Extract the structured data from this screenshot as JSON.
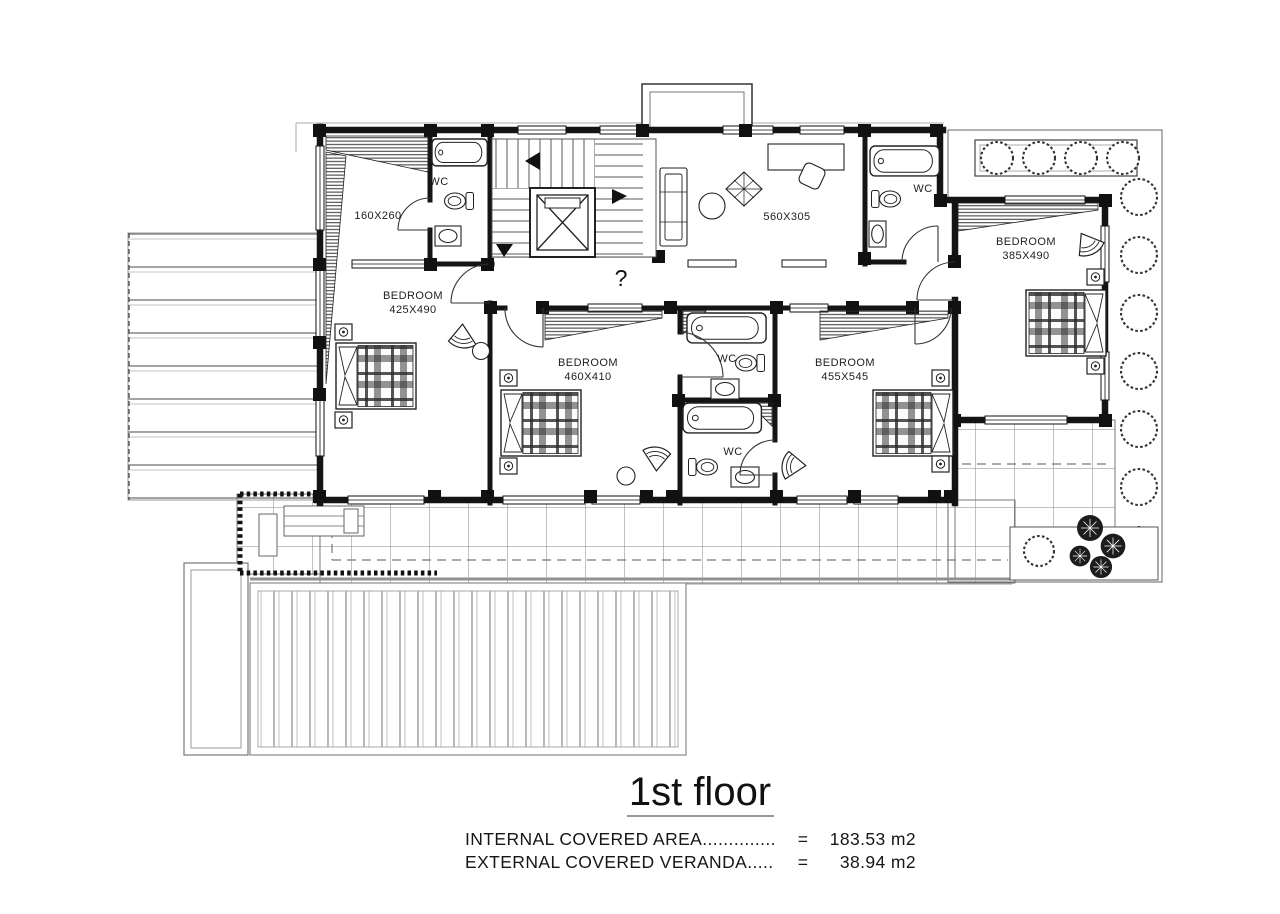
{
  "plan": {
    "rooms": {
      "dressing": {
        "dim": "160X260"
      },
      "wc_top_left": {
        "label": "WC"
      },
      "wc_top_right": {
        "label": "WC"
      },
      "wc_middle_upper": {
        "label": "WC"
      },
      "wc_middle_lower": {
        "label": "WC"
      },
      "hall": {
        "dim": "560X305"
      },
      "bedroom1": {
        "name": "BEDROOM",
        "dim": "425X490"
      },
      "bedroom2": {
        "name": "BEDROOM",
        "dim": "460X410"
      },
      "bedroom3": {
        "name": "BEDROOM",
        "dim": "455X545"
      },
      "bedroom4": {
        "name": "BEDROOM",
        "dim": "385X490"
      }
    },
    "stair_mark": "?"
  },
  "footer": {
    "title": "1st floor",
    "areas": [
      {
        "label": "INTERNAL COVERED AREA..............",
        "eq": "=",
        "value": "183.53 m2"
      },
      {
        "label": "EXTERNAL COVERED VERANDA.....",
        "eq": "=",
        "value": "38.94 m2"
      }
    ]
  }
}
